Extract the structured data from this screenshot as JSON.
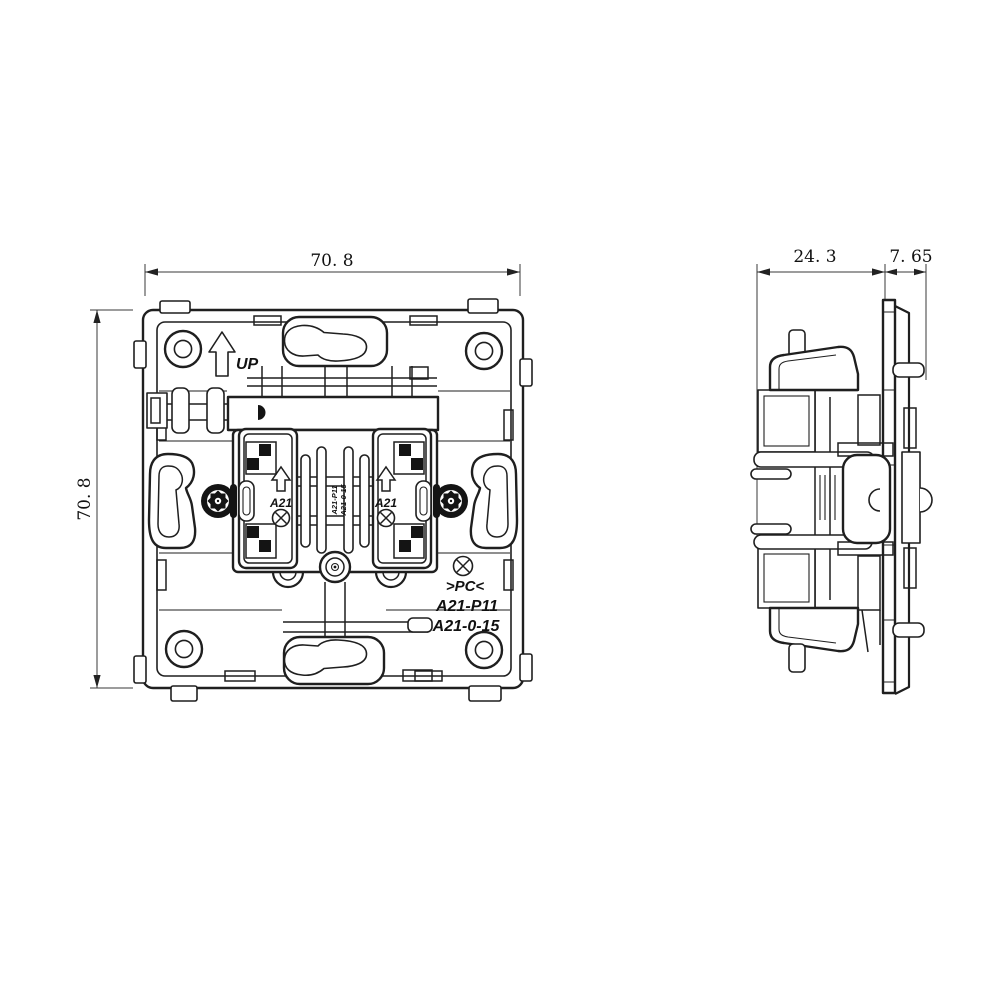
{
  "title": "Flush-mounted switch mechanism - technical drawing (front and side views)",
  "colors": {
    "background": "#ffffff",
    "line": "#1f1f1f",
    "dimension": "#3a3a3a"
  },
  "front_view": {
    "dim_width": "70. 8",
    "dim_height": "70. 8",
    "up_label": "UP",
    "terminal_left_label": "A21",
    "terminal_right_label": "A21",
    "center_marking_left": "A21-P11",
    "center_marking_right": "A21-0-15",
    "material_label": ">PC<",
    "model_label_1": "A21-P11",
    "model_label_2": "A21-0-15"
  },
  "side_view": {
    "dim_depth_body": "24. 3",
    "dim_depth_frame": "7. 65"
  }
}
